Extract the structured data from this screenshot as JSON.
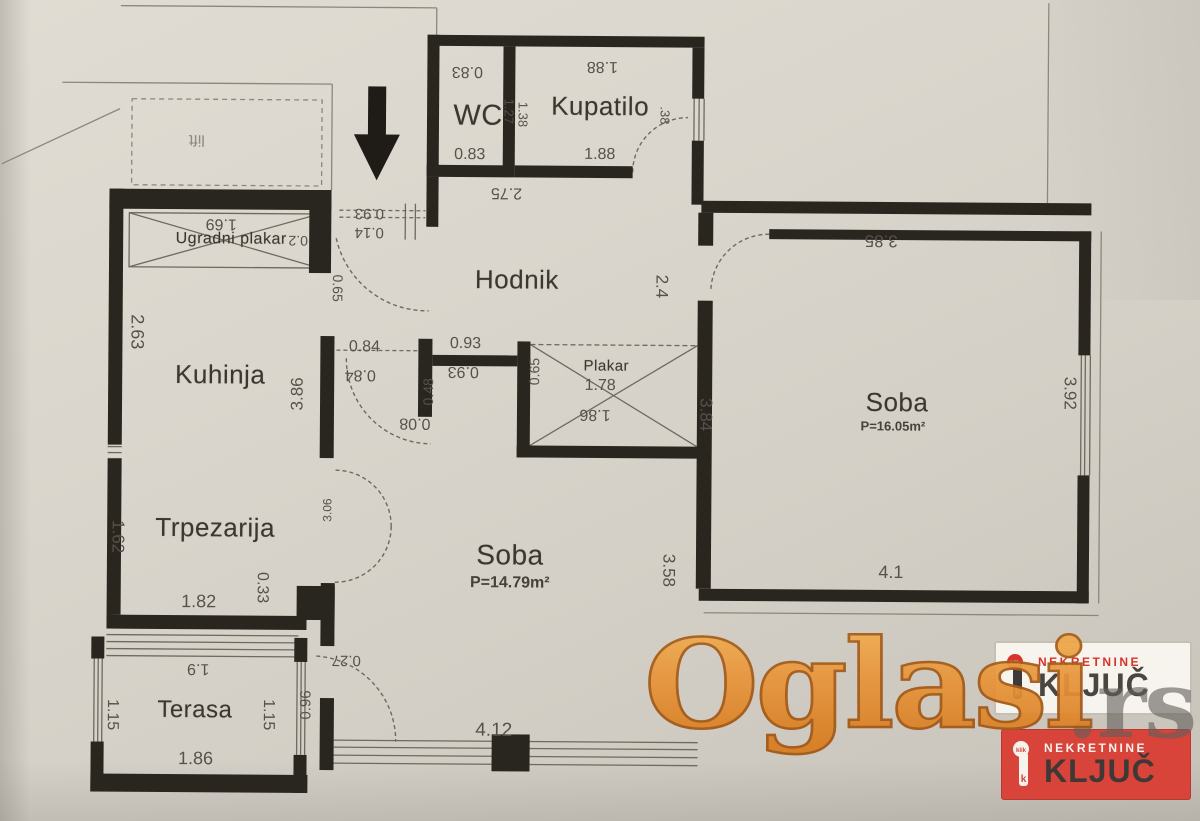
{
  "plan": {
    "rooms": [
      {
        "name": "WC"
      },
      {
        "name": "Kupatilo"
      },
      {
        "name": "Hodnik"
      },
      {
        "name": "Ugradni plakar"
      },
      {
        "name": "Kuhinja"
      },
      {
        "name": "Trpezarija"
      },
      {
        "name": "Soba",
        "area": "P=14.79m²"
      },
      {
        "name": "Soba",
        "area": "P=16.05m²"
      },
      {
        "name": "Terasa"
      },
      {
        "name": "Plakar"
      },
      {
        "name": "lift"
      }
    ],
    "dimensions": [
      {
        "value": "0.83"
      },
      {
        "value": "1.88"
      },
      {
        "value": "1.27"
      },
      {
        "value": "1.38"
      },
      {
        "value": "0.83"
      },
      {
        "value": "1.88"
      },
      {
        "value": ".38"
      },
      {
        "value": "2.75"
      },
      {
        "value": "0.93"
      },
      {
        "value": "0.14"
      },
      {
        "value": "0.65"
      },
      {
        "value": "1.69"
      },
      {
        "value": "0.2"
      },
      {
        "value": "2.63"
      },
      {
        "value": "3.86"
      },
      {
        "value": "2.4"
      },
      {
        "value": "3.85"
      },
      {
        "value": "0.84"
      },
      {
        "value": "0.84"
      },
      {
        "value": "0.93"
      },
      {
        "value": "0.93"
      },
      {
        "value": "0.48"
      },
      {
        "value": "0.08"
      },
      {
        "value": "0.65"
      },
      {
        "value": "1.78"
      },
      {
        "value": "1.86"
      },
      {
        "value": "3.84"
      },
      {
        "value": "3.92"
      },
      {
        "value": "3.58"
      },
      {
        "value": "4.1"
      },
      {
        "value": "1.62"
      },
      {
        "value": "1.82"
      },
      {
        "value": "0.33"
      },
      {
        "value": "3.06"
      },
      {
        "value": "1.9"
      },
      {
        "value": "0.27"
      },
      {
        "value": "1.15"
      },
      {
        "value": "1.15"
      },
      {
        "value": "0.96"
      },
      {
        "value": "1.86"
      },
      {
        "value": "4.12"
      }
    ]
  },
  "watermark": {
    "brand": "Oglasi",
    "suffix": ".rs"
  },
  "badges": [
    {
      "top": "NEKRETNINE",
      "bottom": "KLJUČ",
      "variant": "light"
    },
    {
      "top": "NEKRETNINE",
      "bottom": "KLJUČ",
      "variant": "red"
    }
  ],
  "colors": {
    "paper": "#d8d4cb",
    "wall": "#29251f",
    "thin_line": "#8d877b",
    "watermark_orange": "#e8953a",
    "badge_red": "#d8433a"
  }
}
